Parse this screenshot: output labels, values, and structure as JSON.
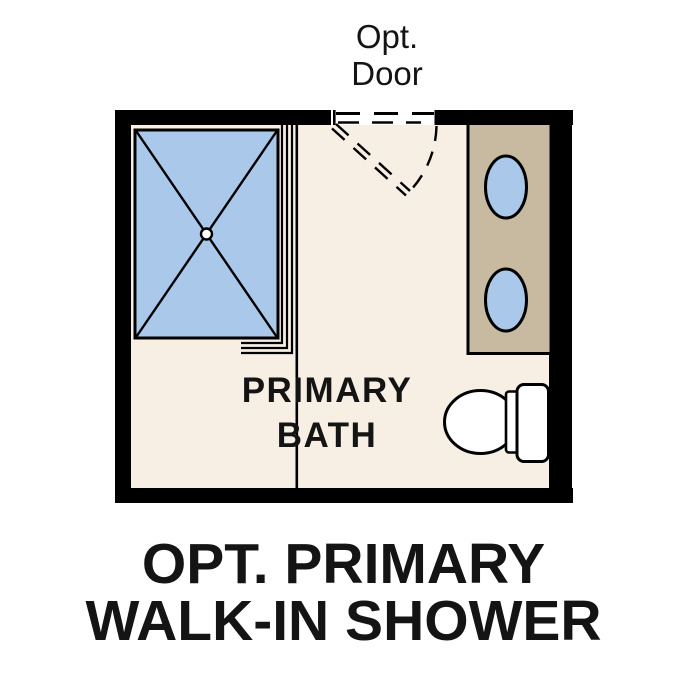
{
  "page": {
    "background": "#ffffff"
  },
  "colors": {
    "wall": "#000000",
    "floor": "#f7efe4",
    "fixture_blue": "#a9c8ea",
    "vanity_tan": "#c7baa1",
    "fixture_white": "#ffffff",
    "text": "#141414"
  },
  "labels": {
    "door": "Opt.\nDoor",
    "room": "PRIMARY\nBATH",
    "caption": "OPT. PRIMARY\nWALK-IN SHOWER"
  }
}
